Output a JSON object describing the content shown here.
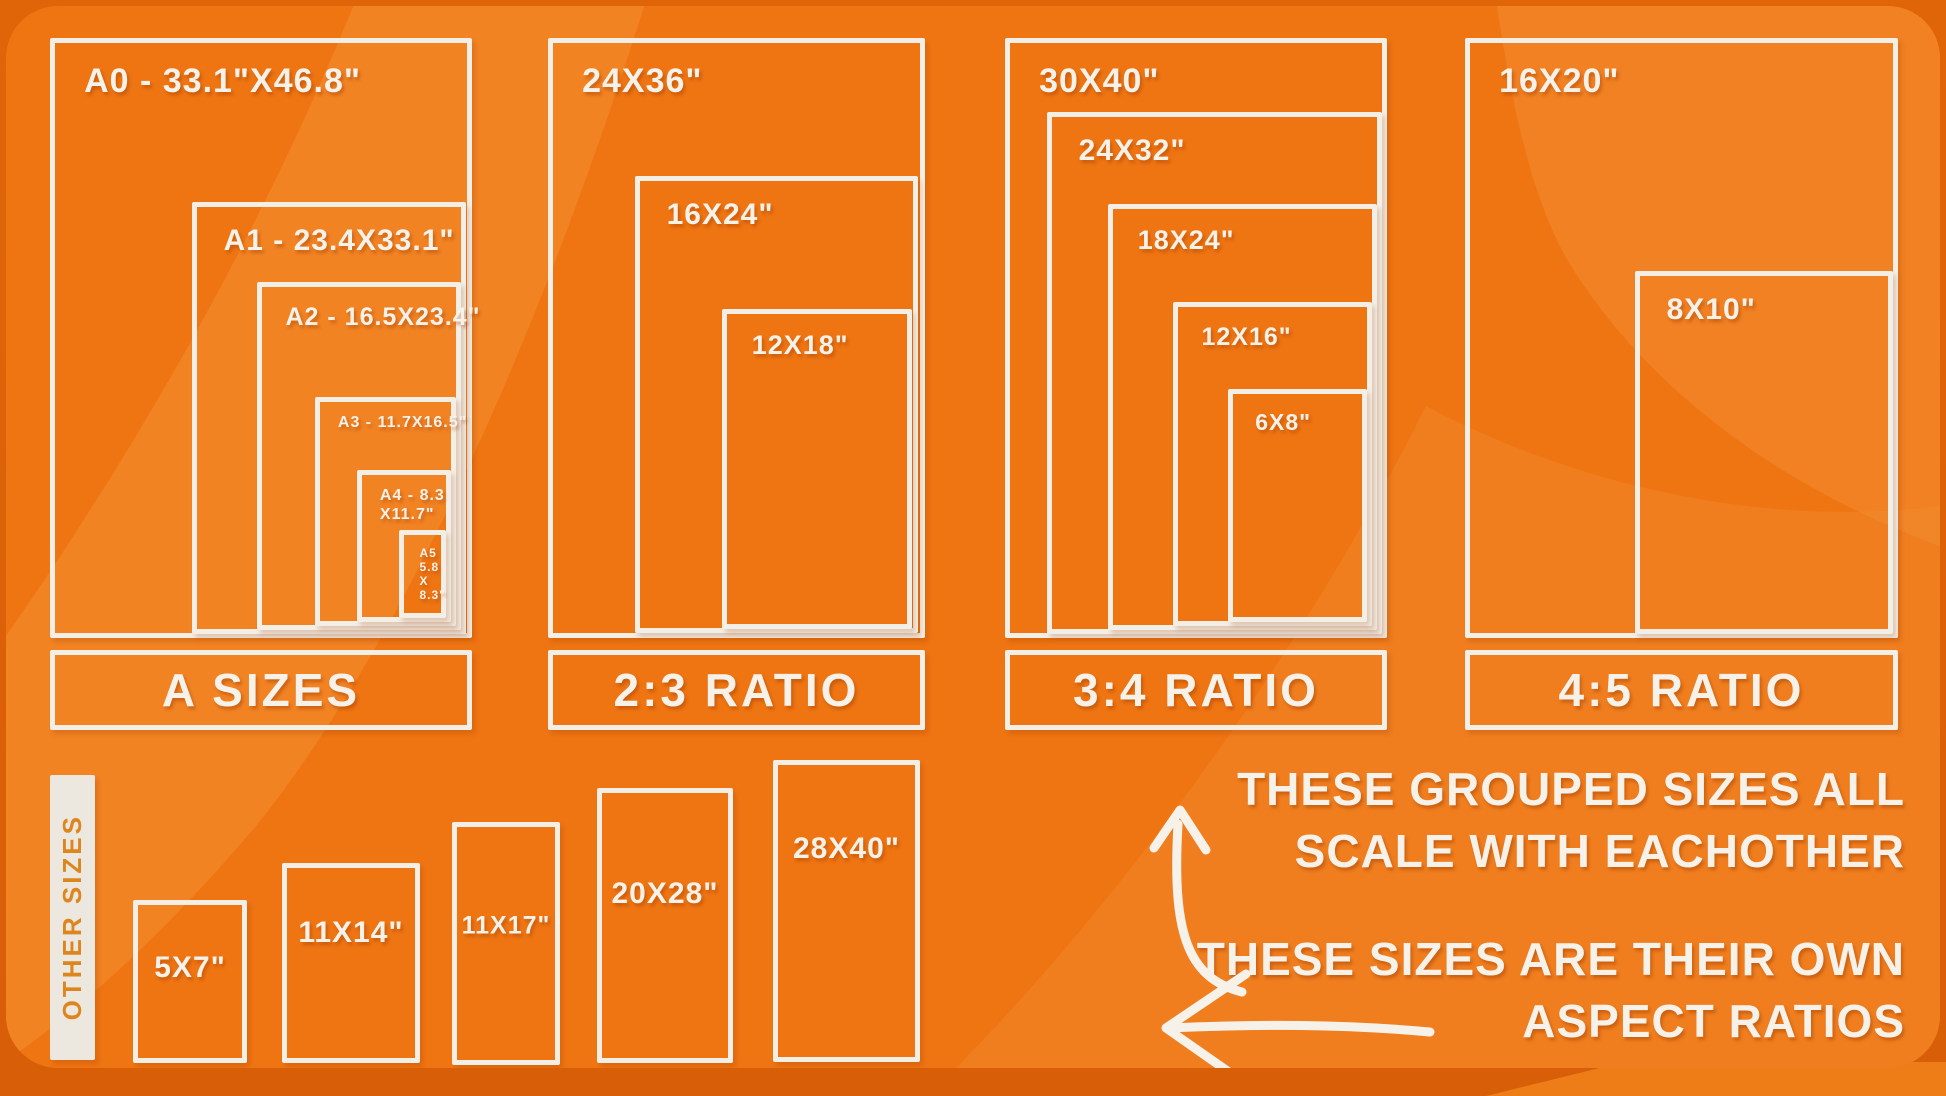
{
  "colors": {
    "canvas_orange": "#ef7512",
    "wave_light": "#f5953c",
    "outer_bg": "#dd640a",
    "patch_orange": "#ee7d17",
    "border_white": "#f3efe6",
    "text_white": "#f6f2ea",
    "other_bar_bg": "#ece8e0",
    "other_bar_text": "#de861e"
  },
  "groups": [
    {
      "id": "a-sizes",
      "label": "A SIZES",
      "bar": {
        "x": 50,
        "y": 650,
        "w": 422,
        "h": 80
      },
      "boxes": [
        {
          "id": "a0",
          "label": "A0 - 33.1\"X46.8\"",
          "x": 50,
          "y": 38,
          "w": 422,
          "h": 600,
          "fs": 34
        },
        {
          "id": "a1",
          "label": "A1 - 23.4X33.1\"",
          "x": 192,
          "y": 202,
          "w": 274,
          "h": 432,
          "fs": 30
        },
        {
          "id": "a2",
          "label": "A2 - 16.5X23.4\"",
          "x": 257,
          "y": 282,
          "w": 204,
          "h": 348,
          "fs": 25
        },
        {
          "id": "a3",
          "label": "A3 - 11.7X16.5\"",
          "x": 315,
          "y": 397,
          "w": 141,
          "h": 229,
          "fs": 16
        },
        {
          "id": "a4",
          "lines": [
            "A4 - 8.3",
            "X11.7\""
          ],
          "x": 357,
          "y": 470,
          "w": 94,
          "h": 152,
          "fs": 16
        },
        {
          "id": "a5",
          "lines": [
            "A5",
            "5.8",
            "X",
            "8.3\""
          ],
          "x": 399,
          "y": 530,
          "w": 47,
          "h": 88,
          "fs": 12
        }
      ]
    },
    {
      "id": "ratio-2-3",
      "label": "2:3 RATIO",
      "bar": {
        "x": 548,
        "y": 650,
        "w": 377,
        "h": 80
      },
      "boxes": [
        {
          "id": "24x36",
          "label": "24X36\"",
          "x": 548,
          "y": 38,
          "w": 377,
          "h": 600,
          "fs": 34
        },
        {
          "id": "16x24",
          "label": "16X24\"",
          "x": 635,
          "y": 176,
          "w": 283,
          "h": 457,
          "fs": 30
        },
        {
          "id": "12x18",
          "label": "12X18\"",
          "x": 722,
          "y": 309,
          "w": 190,
          "h": 320,
          "fs": 27
        }
      ]
    },
    {
      "id": "ratio-3-4",
      "label": "3:4 RATIO",
      "bar": {
        "x": 1005,
        "y": 650,
        "w": 382,
        "h": 80
      },
      "boxes": [
        {
          "id": "30x40",
          "label": "30X40\"",
          "x": 1005,
          "y": 38,
          "w": 382,
          "h": 600,
          "fs": 34
        },
        {
          "id": "24x32",
          "label": "24X32\"",
          "x": 1047,
          "y": 112,
          "w": 335,
          "h": 522,
          "fs": 30
        },
        {
          "id": "18x24",
          "label": "18X24\"",
          "x": 1108,
          "y": 204,
          "w": 269,
          "h": 426,
          "fs": 27
        },
        {
          "id": "12x16",
          "label": "12X16\"",
          "x": 1173,
          "y": 302,
          "w": 199,
          "h": 324,
          "fs": 25
        },
        {
          "id": "6x8",
          "label": "6X8\"",
          "x": 1228,
          "y": 389,
          "w": 139,
          "h": 233,
          "fs": 23
        }
      ]
    },
    {
      "id": "ratio-4-5",
      "label": "4:5 RATIO",
      "bar": {
        "x": 1465,
        "y": 650,
        "w": 433,
        "h": 80
      },
      "boxes": [
        {
          "id": "16x20",
          "label": "16X20\"",
          "x": 1465,
          "y": 38,
          "w": 433,
          "h": 600,
          "fs": 34
        },
        {
          "id": "8x10",
          "label": "8X10\"",
          "x": 1635,
          "y": 271,
          "w": 258,
          "h": 363,
          "fs": 30
        }
      ]
    }
  ],
  "other_sizes": {
    "label": "OTHER SIZES",
    "boxes": [
      {
        "id": "5x7",
        "label": "5X7\"",
        "x": 133,
        "y": 900,
        "w": 114,
        "h": 163,
        "fs": 30,
        "dy": -14
      },
      {
        "id": "11x14",
        "label": "11X14\"",
        "x": 282,
        "y": 863,
        "w": 138,
        "h": 200,
        "fs": 30,
        "dy": -30
      },
      {
        "id": "11x17",
        "label": "11X17\"",
        "x": 452,
        "y": 822,
        "w": 108,
        "h": 243,
        "fs": 25,
        "dy": -18
      },
      {
        "id": "20x28",
        "label": "20X28\"",
        "x": 597,
        "y": 788,
        "w": 136,
        "h": 275,
        "fs": 30,
        "dy": -32
      },
      {
        "id": "28x40",
        "label": "28X40\"",
        "x": 773,
        "y": 760,
        "w": 147,
        "h": 302,
        "fs": 30,
        "dy": -62
      }
    ]
  },
  "annotations": {
    "grouped": {
      "line1": "THESE GROUPED SIZES ALL",
      "line2": "SCALE WITH EACHOTHER"
    },
    "own": {
      "line1": "THESE SIZES ARE THEIR OWN",
      "line2": "ASPECT RATIOS"
    }
  }
}
